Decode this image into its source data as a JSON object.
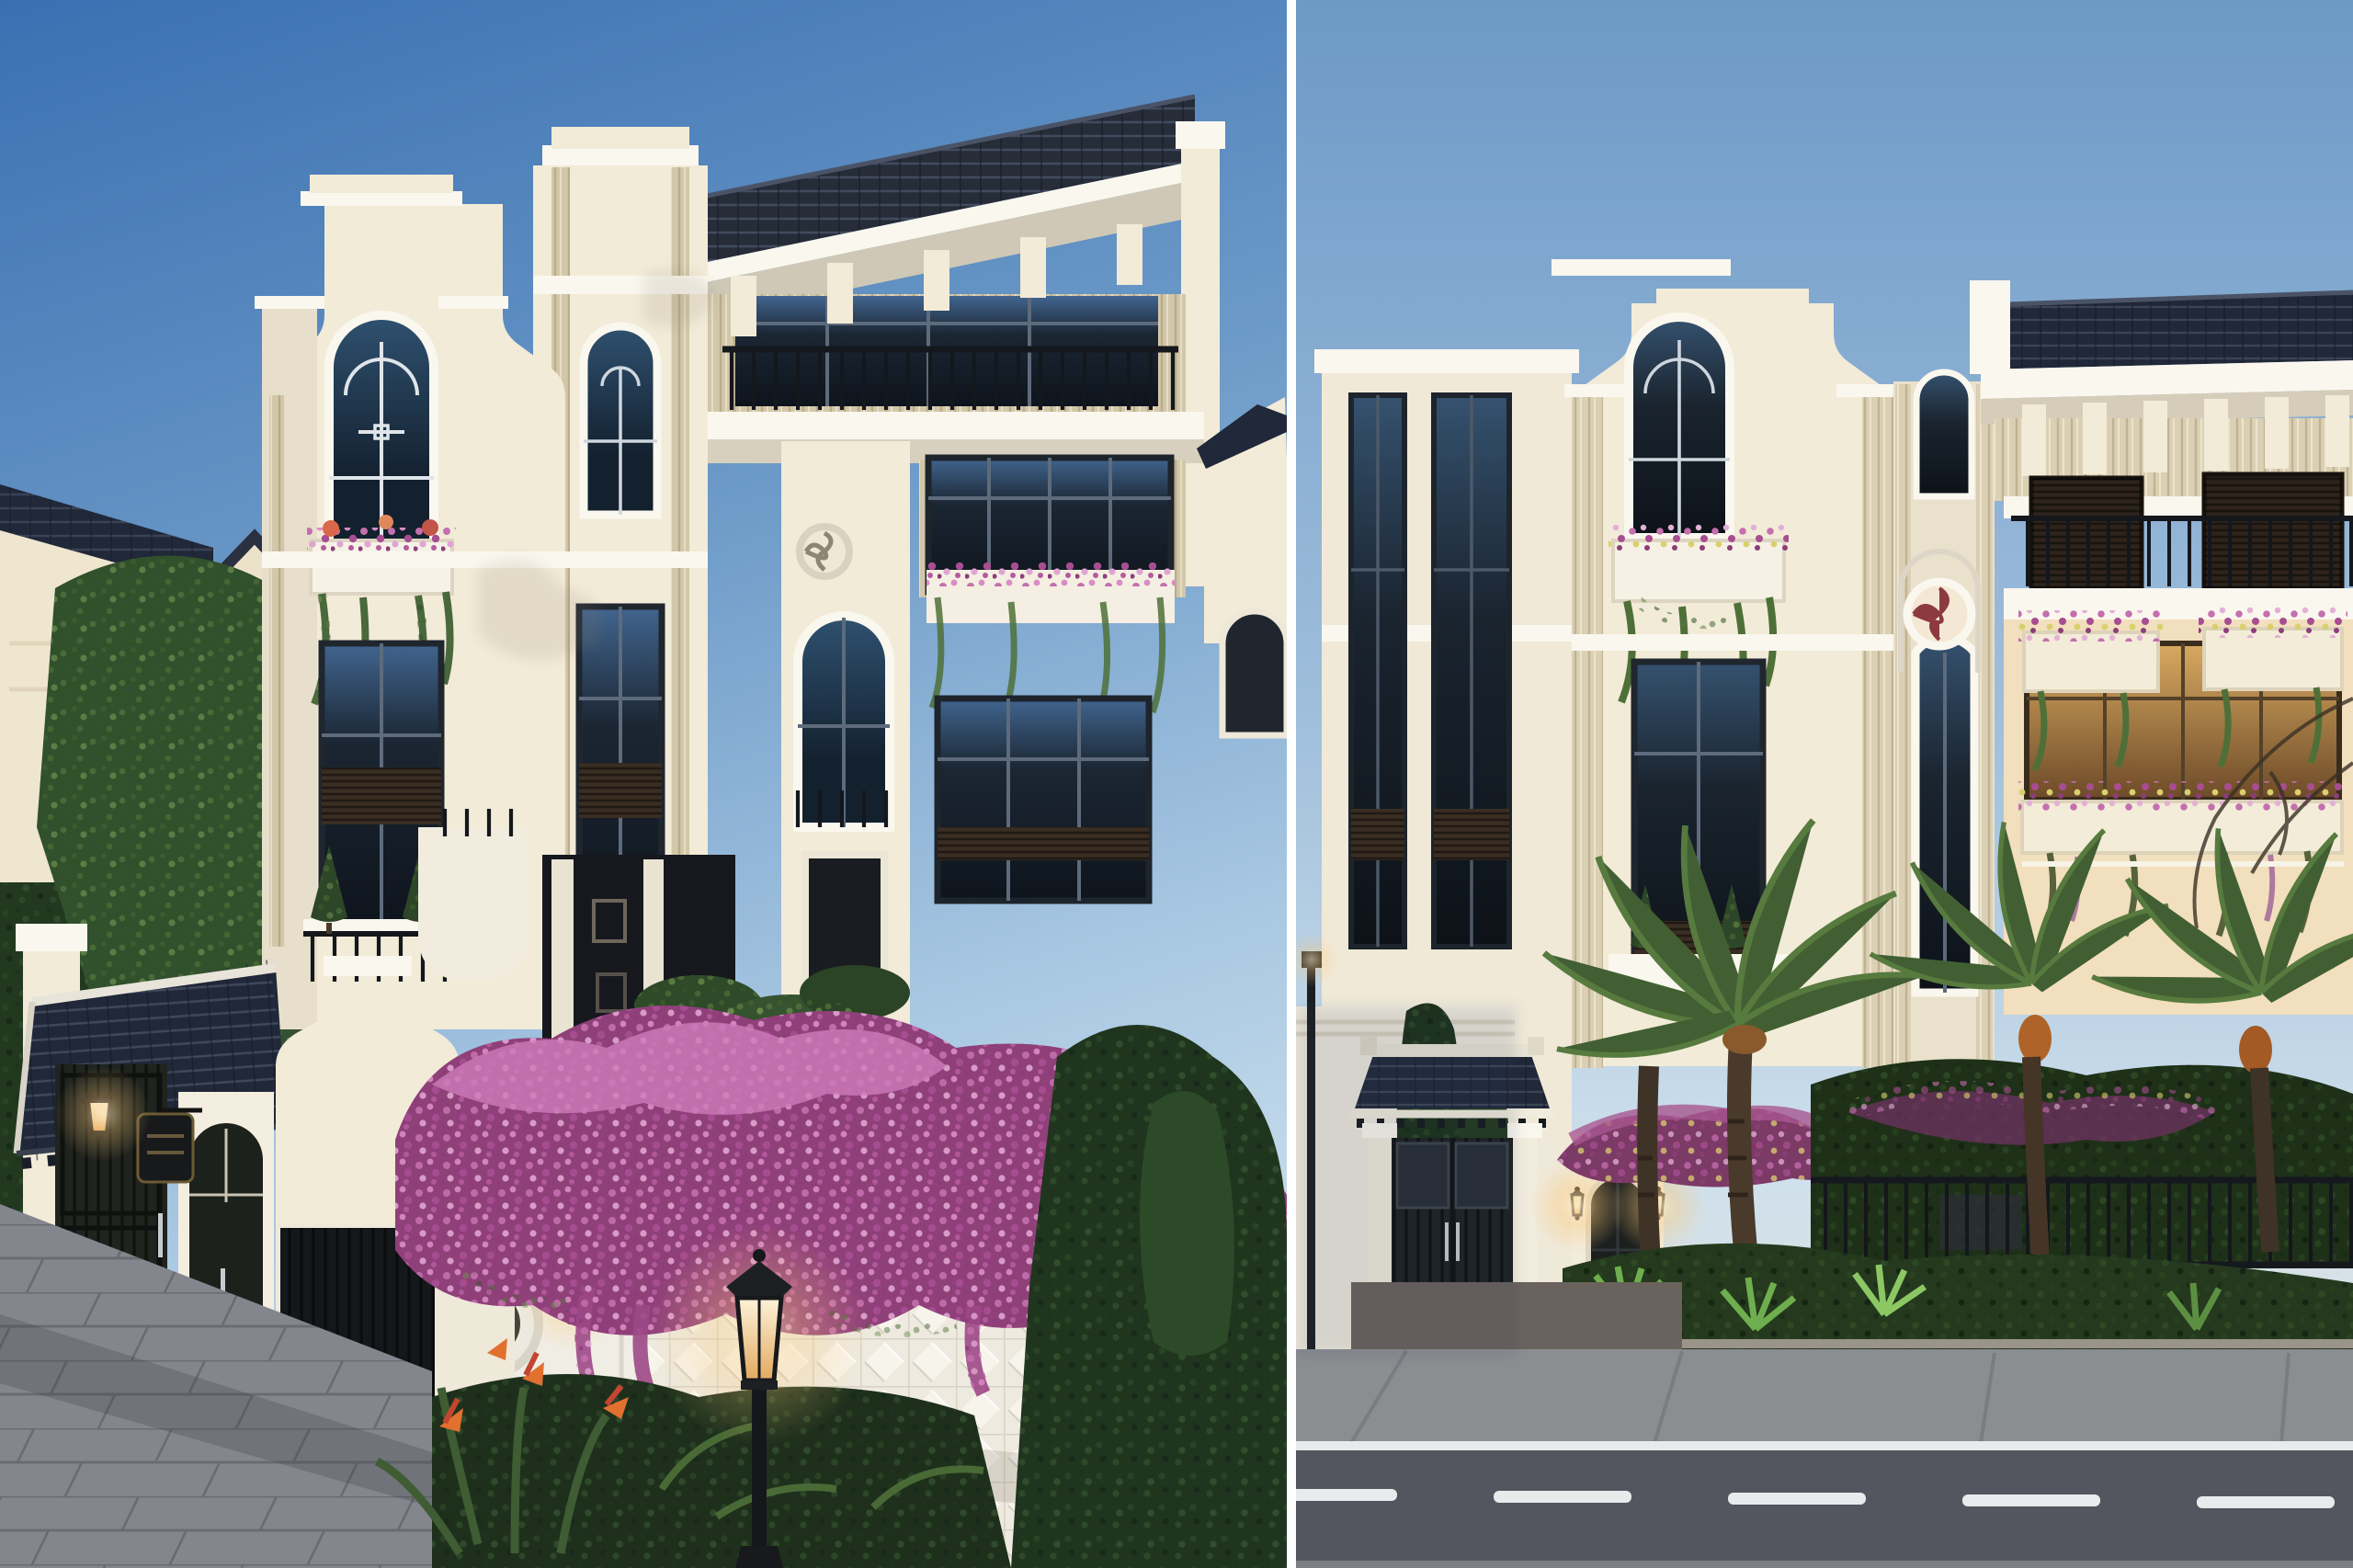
{
  "meta": {
    "title": "Two architectural renders of a white Indochine-style villa",
    "panel_count": 2
  },
  "panels": {
    "left": {
      "label": "Daytime corner view: white neoclassical Indochine villa with dark tiled roofs, gatehouse with navy tiled roof, dark timber gates, white fence wall draped in purple bougainvillea, lit street lantern and stone paving"
    },
    "right": {
      "label": "Dusk frontal view: villa facade with curved gable, dark tile roof band, planter balconies, entrance gate with Vietnamese tiled canopy, lit wall lanterns, palm trees, metal fence and asphalt road with white lane dashes"
    }
  },
  "palette": {
    "gutter": "#ffffff",
    "skyL1": "#3a70b2",
    "skyL2": "#6f9cc9",
    "skyL3": "#a9c8e2",
    "skyL4": "#cbdfec",
    "skyR1": "#6d99c7",
    "skyR2": "#9ebedb",
    "skyR3": "#cfe0ec",
    "skyR4": "#e9e4d6",
    "cream": "#f2ebd8",
    "creamHi": "#faf7ee",
    "creamShade": "#ddd4c2",
    "creamWarm": "#f2dfbd",
    "tan": "#d3c7a9",
    "roof": "#262c38",
    "roofHi": "#454e62",
    "roofNavy": "#202839",
    "glassDark": "#0e141c",
    "glassBlue": "#41658f",
    "mullion": "#5d6b7c",
    "wood": "#20241f",
    "woodBrown": "#3a2e23",
    "boug": "#a04a8c",
    "bougHi": "#cd7cba",
    "bougDeep": "#6f3161",
    "leafDark": "#22381f",
    "leafMid": "#3c5c36",
    "leafLight": "#5d7f49",
    "palm": "#415f33",
    "pave": "#83868c",
    "road": "#53565e",
    "sidewalk": "#8b8d91",
    "marking": "#e8eaec",
    "glow": "#ffdf9f",
    "lantern": "#1b1b1d",
    "maroon": "#8c3a3f",
    "urn": "#efe9da"
  }
}
